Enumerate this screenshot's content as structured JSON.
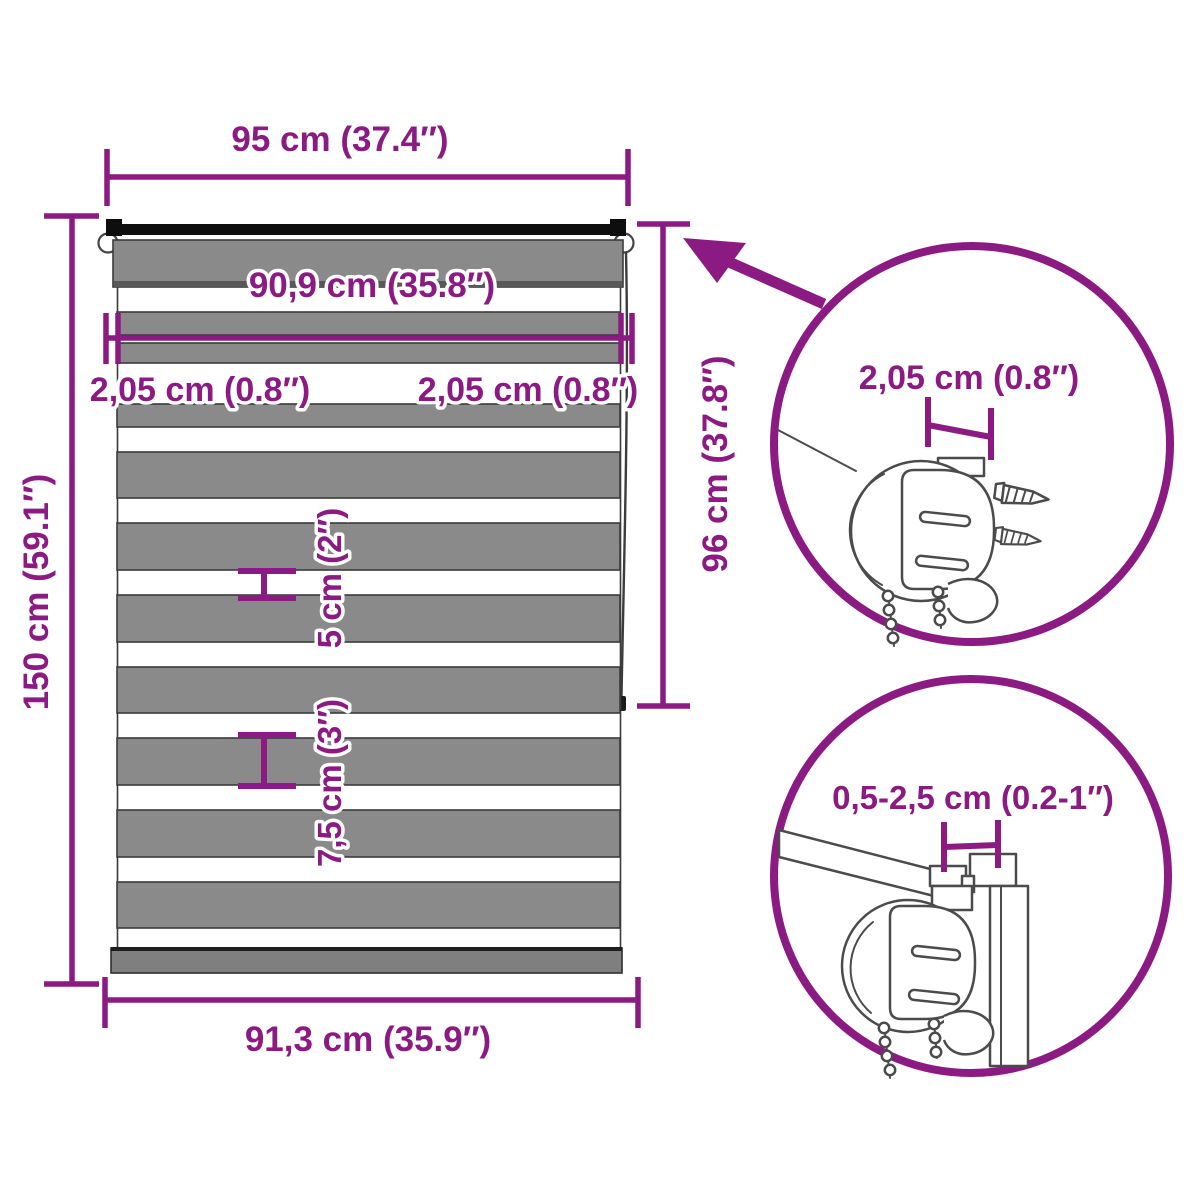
{
  "colors": {
    "accent_purple": "#8B1A82",
    "stripe_gray": "#8A8A8A",
    "stripe_border": "#3B3B3B",
    "tube_black": "#0E0E0E",
    "rail_gray": "#7F7F7F",
    "line_art_gray": "#4B4B4B",
    "background": "#FFFFFF"
  },
  "dimensions": {
    "top_width": "95 cm (37.4″)",
    "fabric_width": "90,9 cm (35.8″)",
    "side_gap_left": "2,05 cm (0.8″)",
    "side_gap_right": "2,05 cm (0.8″)",
    "total_height": "150 cm (59.1″)",
    "roll_height": "96 cm (37.8″)",
    "white_stripe": "5 cm (2″)",
    "gray_stripe": "7,5 cm (3″)",
    "bottom_width": "91,3 cm (35.9″)",
    "detail_top_gap": "2,05 cm (0.8″)",
    "detail_bottom_range": "0,5-2,5 cm (0.2-1″)"
  }
}
